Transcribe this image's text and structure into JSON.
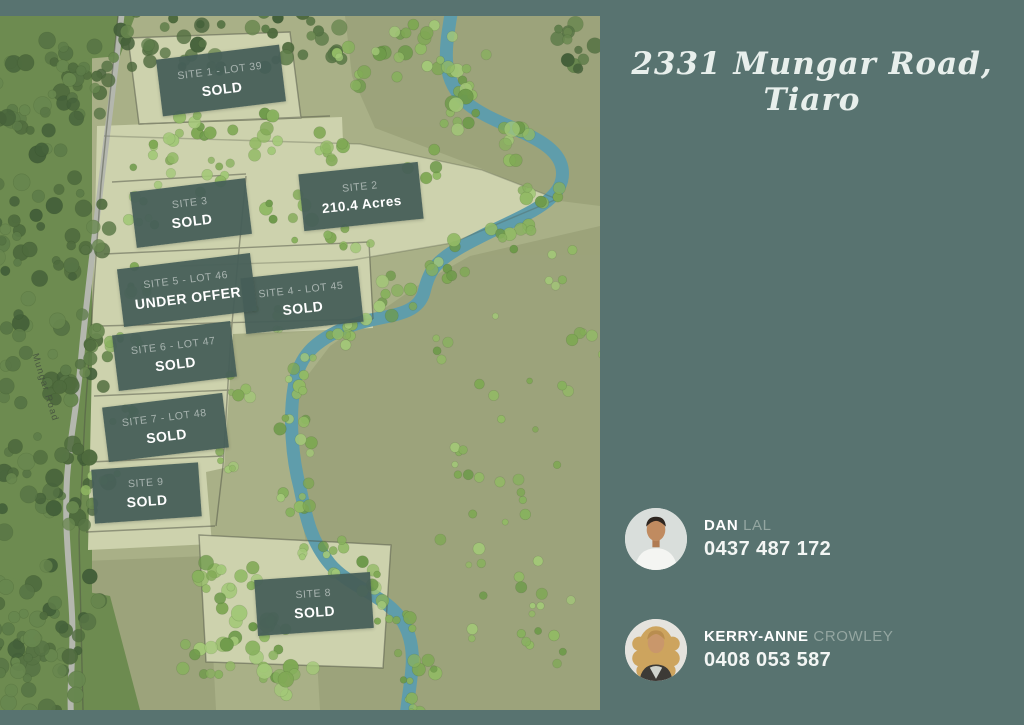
{
  "title": "2331 Mungar Road, Tiaro",
  "map": {
    "road_label": "Mungar Road",
    "sites": [
      {
        "line1": "SITE 1 - LOT 39",
        "line2": "SOLD"
      },
      {
        "line1": "SITE 2",
        "line2": "210.4 Acres"
      },
      {
        "line1": "SITE 3",
        "line2": "SOLD"
      },
      {
        "line1": "SITE 4 - LOT 45",
        "line2": "SOLD"
      },
      {
        "line1": "SITE 5 - LOT 46",
        "line2": "UNDER OFFER"
      },
      {
        "line1": "SITE 6 - LOT 47",
        "line2": "SOLD"
      },
      {
        "line1": "SITE 7 - LOT 48",
        "line2": "SOLD"
      },
      {
        "line1": "SITE 8",
        "line2": "SOLD"
      },
      {
        "line1": "SITE 9",
        "line2": "SOLD"
      }
    ]
  },
  "agents": [
    {
      "first_name": "DAN",
      "last_name": "LAL",
      "phone": "0437 487 172"
    },
    {
      "first_name": "KERRY-ANNE",
      "last_name": "CROWLEY",
      "phone": "0408 053 587"
    }
  ],
  "logo": {
    "monogram": "AW",
    "tagline": "PROPERTY • PEOPLE"
  },
  "colors": {
    "panel_teal": "#587370",
    "label_box": "#475f58",
    "river_blue": "#5f9dab",
    "field_olive": "#a9b087",
    "cleared_pale": "#cdd2ad",
    "logo_cream": "#ece4d0"
  }
}
